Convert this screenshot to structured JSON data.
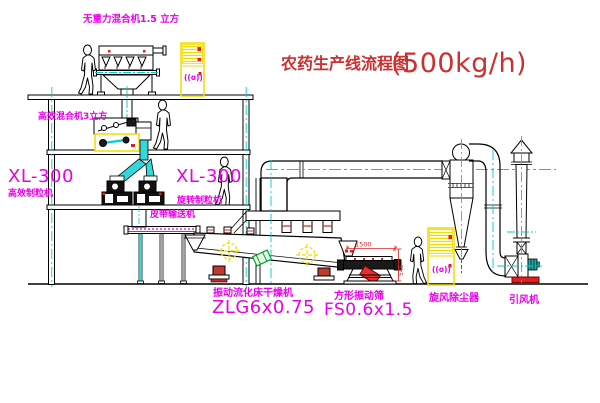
{
  "title": {
    "text": "农药生产线流程图",
    "capacity": "(500kg/h)"
  },
  "labels": {
    "top_mixer": "无重力混合机1.5 立方",
    "second_mixer": "高效混合机3立方",
    "left_granulator_model": "XL-300",
    "left_granulator_name": "高效制粒机",
    "mid_granulator_model": "XL-300",
    "mid_granulator_name": "旋转制粒机",
    "belt_conveyor": "皮带输送机",
    "dryer_name": "振动流化床干燥机",
    "dryer_model": "ZLG6x0.75",
    "screen_name": "方形振动筛",
    "screen_model": "FS0.6x1.5",
    "cyclone": "旋风除尘器",
    "fan": "引风机"
  },
  "dimensions": {
    "screen_length": "1500",
    "screen_height": "545"
  },
  "colors": {
    "linework": "#000000",
    "centerline": "#00cdcd",
    "label_magenta": "#e800e8",
    "title_red": "#cc2f2f",
    "cabinet_yellow": "#f0dc00",
    "detail_red": "#e02020",
    "detail_green": "#00a32e"
  }
}
